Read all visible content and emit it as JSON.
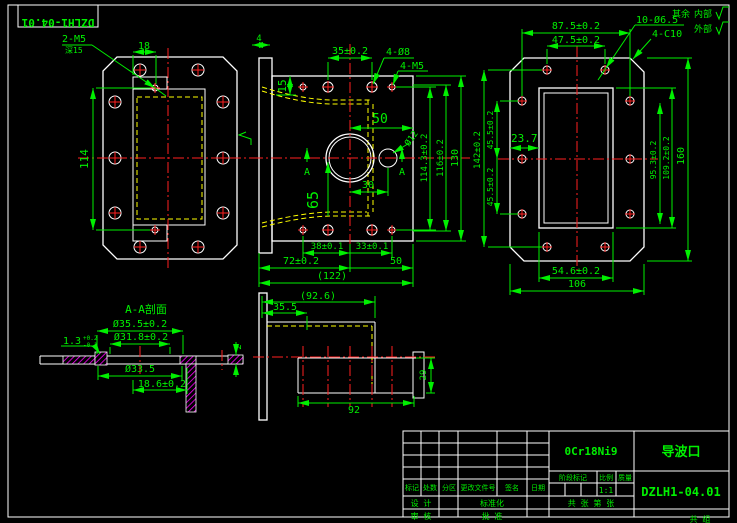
{
  "sheet": {
    "corner_stamp": "DZLH1-04.01",
    "surface_note": {
      "prefix": "其余",
      "inner": "内部",
      "outer": "外部"
    }
  },
  "views": {
    "left": {
      "callout_thread": "2-M5",
      "callout_depth": "深15",
      "dim_width_18": "18",
      "dim_height_114": "114"
    },
    "front": {
      "dim_4": "4",
      "dim_15": "15",
      "dim_35": "35±0.2",
      "label_holes_d8": "4-Ø8",
      "label_holes_m5": "4-M5",
      "dim_50_top": "50",
      "dim_65": "65",
      "dim_30": "30",
      "label_d12": "Ø12",
      "section_a_left": "A",
      "section_a_right": "A",
      "dim_38": "38±0.1",
      "dim_33": "33±0.1",
      "dim_72": "72±0.2",
      "dim_50_bottom": "50",
      "dim_122": "(122)",
      "dim_114_3": "114.3±0.2",
      "dim_116": "116±0.2",
      "dim_130": "130"
    },
    "right": {
      "dim_87_5": "87.5±0.2",
      "dim_47_5": "47.5±0.2",
      "label_holes": "10-Ø6.5",
      "label_chamfer": "4-C10",
      "dim_23_7": "23.7",
      "dim_45_5_upper": "45.5±0.2",
      "dim_45_5_lower": "45.5±0.2",
      "dim_142": "142±0.2",
      "dim_95_3": "95.3±0.2",
      "dim_109_2": "109.2±0.2",
      "dim_160": "160",
      "dim_54_6": "54.6±0.2",
      "dim_106": "106"
    },
    "section": {
      "title": "A-A剖面",
      "dim_d35_5": "Ø35.5±0.2",
      "dim_d31_8": "Ø31.8±0.2",
      "dim_d33_5": "Ø33.5",
      "dim_18_6": "18.6±0.2",
      "dim_1_3": "1.3",
      "tol_upper": "+0.2",
      "tol_lower": "-0.1",
      "dim_2": "2"
    },
    "bottom": {
      "dim_92_6": "(92.6)",
      "dim_35_5": "35.5",
      "dim_92": "92",
      "dim_29": "29"
    }
  },
  "title_block": {
    "material": "0Cr18Ni9",
    "part_name": "导波口",
    "drawing_number": "DZLH1-04.01",
    "revision_headers": [
      "标记",
      "处数",
      "分区",
      "更改文件号",
      "签名",
      "日期"
    ],
    "stage_mark_label": "阶段标记",
    "scale_label": "比例",
    "mass_label": "质量",
    "scale_value": "1:1",
    "sheet_info": "共 张 第 张",
    "sign_design": "设 计",
    "sign_standard": "标准化",
    "sign_check": "审 核",
    "sign_approve": "批 准",
    "bottom_partial": "共 组"
  },
  "colors": {
    "background": "#000000",
    "geometry": "#ffffff",
    "dimension": "#00f000",
    "centerline": "#ff2020",
    "hidden": "#ffff00",
    "hatch": "#ff00ff"
  }
}
